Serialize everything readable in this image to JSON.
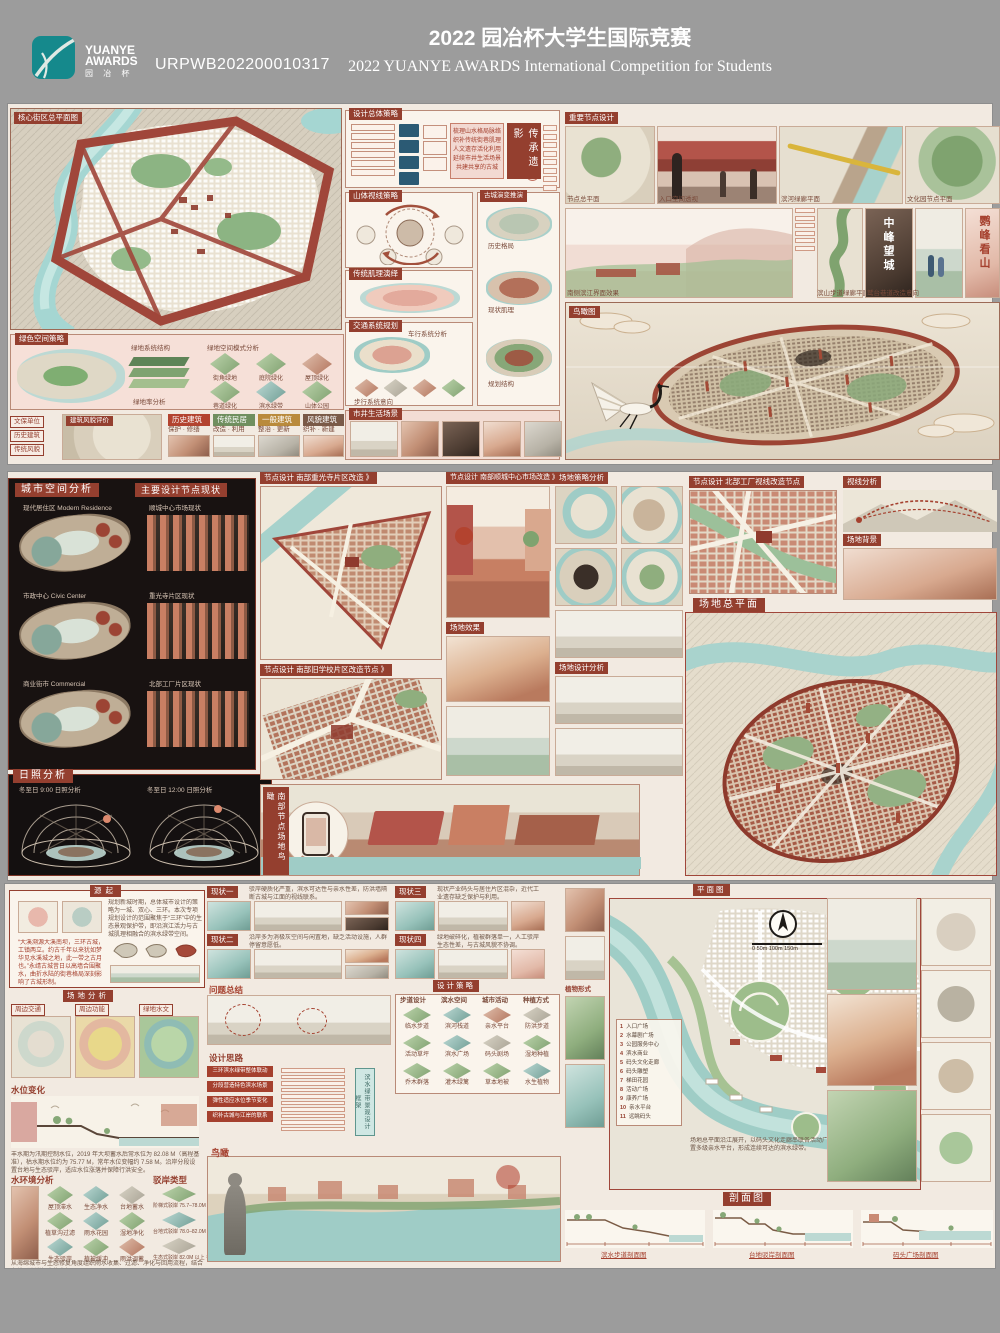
{
  "header": {
    "logo_top": "YUANYE",
    "logo_mid": "AWARDS",
    "logo_cn": "园 冶 杯",
    "entry_id": "URPWB202200010317",
    "title_cn": "2022 园冶杯大学生国际竞赛",
    "title_en": "2022 YUANYE AWARDS International Competition for  Students"
  },
  "b1": {
    "map_label": "核心街区总平面图",
    "green": {
      "title": "绿色空间策略",
      "cap_left": "绿地系统结构",
      "cap_right": "绿地空间模式分析",
      "legend": "绿地率分析",
      "tiles": [
        "街角绿地",
        "庭院绿化",
        "屋顶绿化",
        "巷道绿化",
        "滨水绿带",
        "山体公园"
      ]
    },
    "strip": {
      "map_tag": "建筑风貌评价",
      "side": [
        "文保单位",
        "历史建筑",
        "传统风貌"
      ],
      "cards": [
        {
          "tag": "历史建筑",
          "sub": "保护 · 修缮"
        },
        {
          "tag": "传统民居",
          "sub": "改造 · 利用"
        },
        {
          "tag": "一般建筑",
          "sub": "整治 · 更新"
        },
        {
          "tag": "风貌建筑",
          "sub": "织补 · 新建"
        }
      ]
    },
    "strategy": {
      "title": "设计总体策略",
      "banner": "传承遗影",
      "circles": [
        "传",
        "承",
        "遗",
        "影"
      ],
      "note": "梳理山水格局脉络\n织补传统街巷肌理\n人文遗存活化利用\n延续市井生活场景\n共建共享的古城"
    },
    "mountain": {
      "title": "山体视线策略"
    },
    "texture": {
      "title": "传统肌理演绎"
    },
    "traffic": {
      "title": "交通系统规划",
      "sub": "车行系统分析",
      "cap": "步行系统意向"
    },
    "evolution": {
      "title": "古城演变推演",
      "items": [
        "历史格局",
        "现状肌理",
        "规划结构"
      ]
    },
    "photos": {
      "title": "市井生活场景"
    },
    "nodes": {
      "title": "重要节点设计",
      "caps": [
        "节点总平面",
        "入口空间透视",
        "滨河绿廊平面",
        "文化园节点平面"
      ],
      "caps2": [
        "南侧滨江界面效果",
        "滨山步道绿廊平面",
        "鹫台巷道改造意向"
      ],
      "v1": "中峰望城",
      "v2": "鹦峰看山"
    },
    "bird": {
      "label": "鸟瞰图"
    }
  },
  "b2": {
    "space": {
      "title": "城市空间分析",
      "sub": "主要设计节点现状",
      "items": [
        "现代居住区 Modern Residence",
        "市政中心 Civic Center",
        "商业街市 Commercial"
      ],
      "rights": [
        "顺城中心市场现状",
        "重光寺片区现状",
        "北部工厂片区现状"
      ]
    },
    "sun": {
      "title": "日照分析",
      "caps": [
        "冬至日 9:00 日照分析",
        "冬至日 12:00 日照分析"
      ]
    },
    "node1": "节点设计 南部重光寺片区改造 》",
    "node2": "节点设计 南部顺城中心市场改造 》",
    "node4": "节点设计 南部旧学校片区改造节点 》",
    "strategy": "场地策略分析",
    "node3": "节点设计 北部工厂视线改造节点",
    "sight": "视线分析",
    "bg": "场地背景",
    "master": "场地总平面",
    "effect": "场地效果",
    "analysis": "场地设计分析",
    "vbird": "南部节点场地鸟瞰"
  },
  "b3": {
    "origin": {
      "title": "源起",
      "para": "规划新城时期，总体城市设计的策略为一城、双心、三环。本次专项规划设计的范围聚焦于“三环”中的生态景观保护带，即沿滨江活力与古城肌理相融合的滨水绿带空间。",
      "red": "“大溪溯源大溪南坝，三环古城，工镇两立。约古千年以来犹如梦华见水溪城之地，此一带之古月也。”永靖古城昔日以高墙合围聚水，曲折水陆的街巷格局深刻影响了古城形制。"
    },
    "analysis": {
      "title": "场地分析",
      "tabs": [
        "周边交通",
        "周边功能",
        "绿地水文"
      ]
    },
    "level": {
      "title": "水位变化",
      "cap": "丰水期为汛期控制水位，2019 年大坝蓄水后常水位为 82.08 M（高程基准），枯水期水位约为 75.77 M，常年水位变幅约 7.58 M。沿岸分段设置台地与生态驳岸，适应水位涨落并保障行洪安全。"
    },
    "env": {
      "title": "水环境分析",
      "tiles": [
        "屋顶滞水",
        "生态净水",
        "台地蓄水",
        "植草沟过滤",
        "雨水花园",
        "湿地净化",
        "生态驳岸",
        "植被缓冲",
        "雨洪调蓄"
      ],
      "note": "从海绵城市与生态修复角度组织雨水收集、过滤、净化与回用流程，结合台地驳岸消解水位变幅。"
    },
    "bank": {
      "title": "驳岸类型",
      "items": [
        "阶梯式驳岸 75.7–78.0M 枯水期",
        "台地式驳岸 78.0–82.0M 常水位",
        "生态式驳岸 82.0M 以上 丰水期"
      ]
    },
    "status": [
      {
        "tag": "现状一",
        "text": "驳岸硬质化严重，滨水可达性与亲水性差，防洪墙隔断古城与江面的视线联系。"
      },
      {
        "tag": "现状二",
        "text": "沿岸多为消极灰空间与闲置地，缺乏活动设施，人群停留意愿低。"
      },
      {
        "tag": "现状三",
        "text": "现状产业码头与居住片区混杂，近代工业遗存缺乏保护与利用。"
      },
      {
        "tag": "现状四",
        "text": "绿地破碎化，植被群落单一，人工驳岸生态性差，与古城风貌不协调。"
      }
    ],
    "problem": "问题总结",
    "strategy": {
      "title": "设计策略",
      "cols": [
        "步道设计",
        "滨水空间",
        "城市活动",
        "种植方式"
      ],
      "tiles": [
        "临水步道",
        "滨河栈道",
        "亲水平台",
        "防洪步道",
        "活动草坪",
        "滨水广场",
        "码头剧场",
        "湿地种植",
        "乔木群落",
        "灌木绿篱",
        "草本地被",
        "水生植物"
      ]
    },
    "idea": {
      "title": "设计思路",
      "boxes": [
        "三环滨水绿带整体联动",
        "分段营造特色滨水场景",
        "弹性适应水位季节变化",
        "织补古城与江岸的联系"
      ],
      "out": "滨水绿带景观设计框架"
    },
    "bird": "鸟瞰",
    "plan": {
      "title": "平面图",
      "plant": "植物形式",
      "scale": "0   50m   100m   150m",
      "legend": [
        "入口广场",
        "水幕剧广场",
        "公园服务中心",
        "滨水商业",
        "码头文化走廊",
        "码头雕塑",
        "梯田花园",
        "活动广场",
        "康养广场",
        "亲水平台",
        "远眺码头"
      ],
      "note": "场地总平面沿江展开，以码头文化走廊串联各活动广场与梯田花园，结合水位变化设置多级亲水平台，形成连续可达的滨水绿带。"
    },
    "sections": {
      "title": "剖面图",
      "caps": [
        "滨水步道剖面图",
        "台地驳岸剖面图",
        "码头广场剖面图"
      ]
    }
  }
}
